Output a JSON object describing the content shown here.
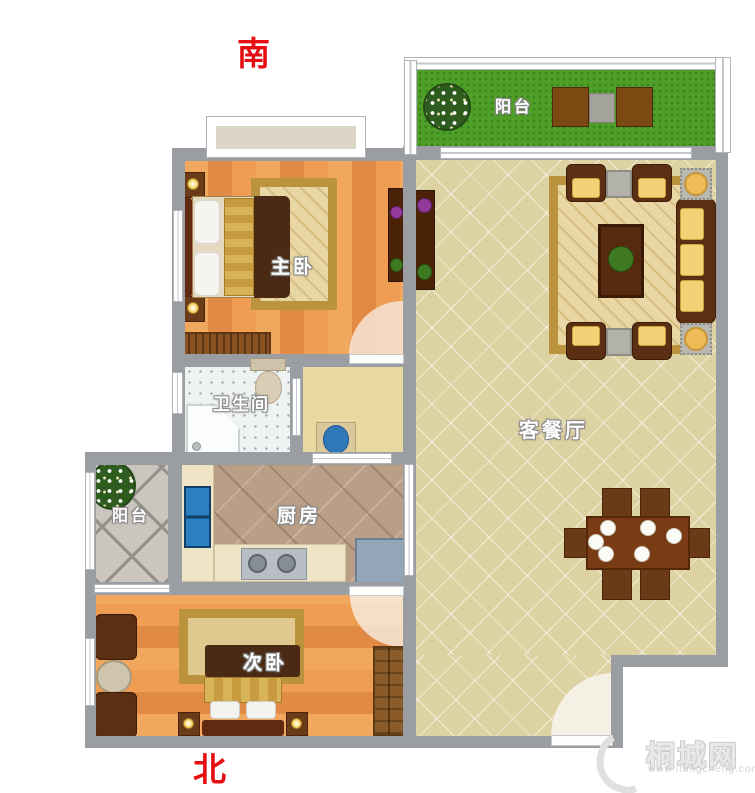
{
  "compass": {
    "south": "南",
    "north": "北"
  },
  "rooms": {
    "balcony_top": {
      "label": "阳台"
    },
    "master_bedroom": {
      "label": "主卧"
    },
    "living_dining": {
      "label": "客餐厅"
    },
    "bathroom": {
      "label": "卫生间"
    },
    "balcony_left": {
      "label": "阳台"
    },
    "kitchen": {
      "label": "厨房"
    },
    "second_bedroom": {
      "label": "次卧"
    }
  },
  "watermark": {
    "site_name": "桐城网",
    "site_url": "www.itongcheng.com"
  },
  "colors": {
    "wall": "#9a9da2",
    "compass_text": "#e60e13",
    "grass": "#4f9e28",
    "wood_floor": "#ec9a50",
    "living_tile": "#ddd2a2",
    "kitchen_tile": "#bb9e86",
    "bath_tile": "#eef2f0",
    "balcony_tile": "#cac6be",
    "hall_floor": "#ead9a0"
  }
}
